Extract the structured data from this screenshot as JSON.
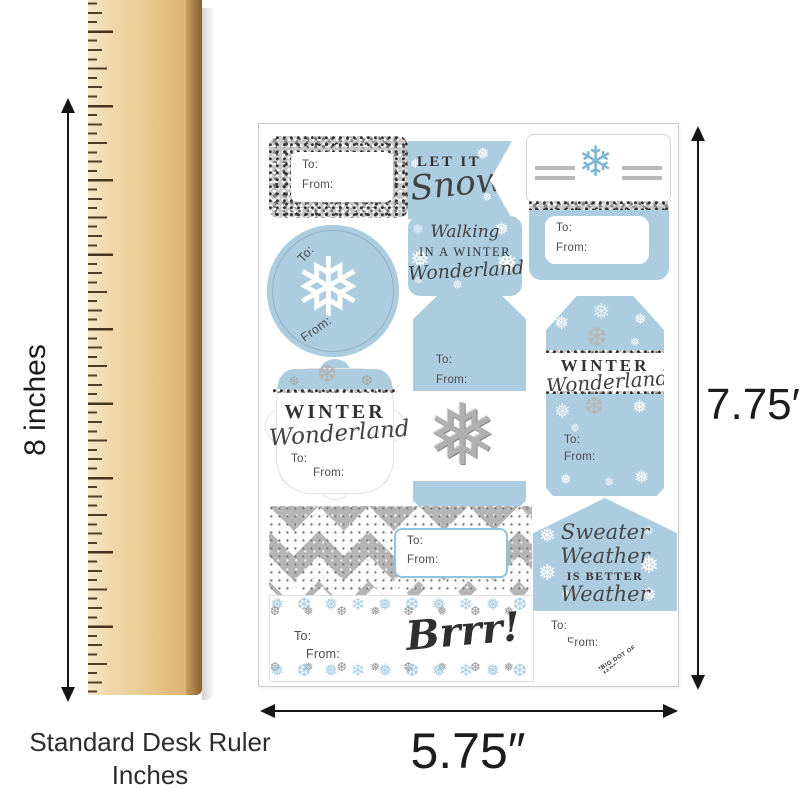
{
  "colors": {
    "tag_blue": "#accddf",
    "snowflake_blue": "#7db5d6",
    "glitter_silver": "#c6c6c6",
    "chevron_silver": "#b5b5b5",
    "text_dark": "#3c3c3c",
    "dimension_black": "#1c1c1c",
    "wood_light": "#f0d9ac",
    "wood_edge": "#a57b46",
    "tick_brown": "#4e3b24",
    "box_border_blue": "#8fc3dc"
  },
  "ruler": {
    "numbers": [
      "9",
      "8",
      "7",
      "6",
      "5",
      "4",
      "3",
      "2",
      "1"
    ],
    "caption_line1": "Standard Desk Ruler",
    "caption_line2": "Inches",
    "height_label": "8 inches"
  },
  "sheet": {
    "height_label": "7.75″",
    "width_label": "5.75″"
  },
  "icons": {
    "snowflake_white": "❅",
    "snowflake_blue": "❄",
    "snowflake_glitter": "❅"
  },
  "tags": {
    "glitter_rect": {
      "to_label": "To:",
      "from_label": "From:"
    },
    "let_it_snow": {
      "line1": "LET IT",
      "line2": "Snow"
    },
    "blue_rect": {
      "to_label": "To:",
      "from_label": "From:"
    },
    "circle": {
      "to_label": "To:",
      "from_label": "From:"
    },
    "walking": {
      "line1": "Walking",
      "line2": "IN A WINTER",
      "line3": "Wonderland"
    },
    "glitter_snowflake": {
      "to_label": "To:",
      "from_label": "From:"
    },
    "winter_wonderland_tall": {
      "line1": "WINTER",
      "line2": "Wonderland",
      "to_label": "To:",
      "from_label": "From:"
    },
    "winter_wonderland_scallop": {
      "line1": "WINTER",
      "line2": "Wonderland",
      "to_label": "To:",
      "from_label": "From:"
    },
    "chevron": {
      "to_label": "To:",
      "from_label": "From:"
    },
    "brrr": {
      "word": "Brrr!",
      "to_label": "To:",
      "from_label": "From:"
    },
    "sweater_weather": {
      "line1": "Sweater",
      "line2": "Weather",
      "line3": "IS BETTER",
      "line4": "Weather",
      "to_label": "To:",
      "from_label": "From:",
      "brand": "*BIG DOT OF HAPPINESS*"
    }
  }
}
